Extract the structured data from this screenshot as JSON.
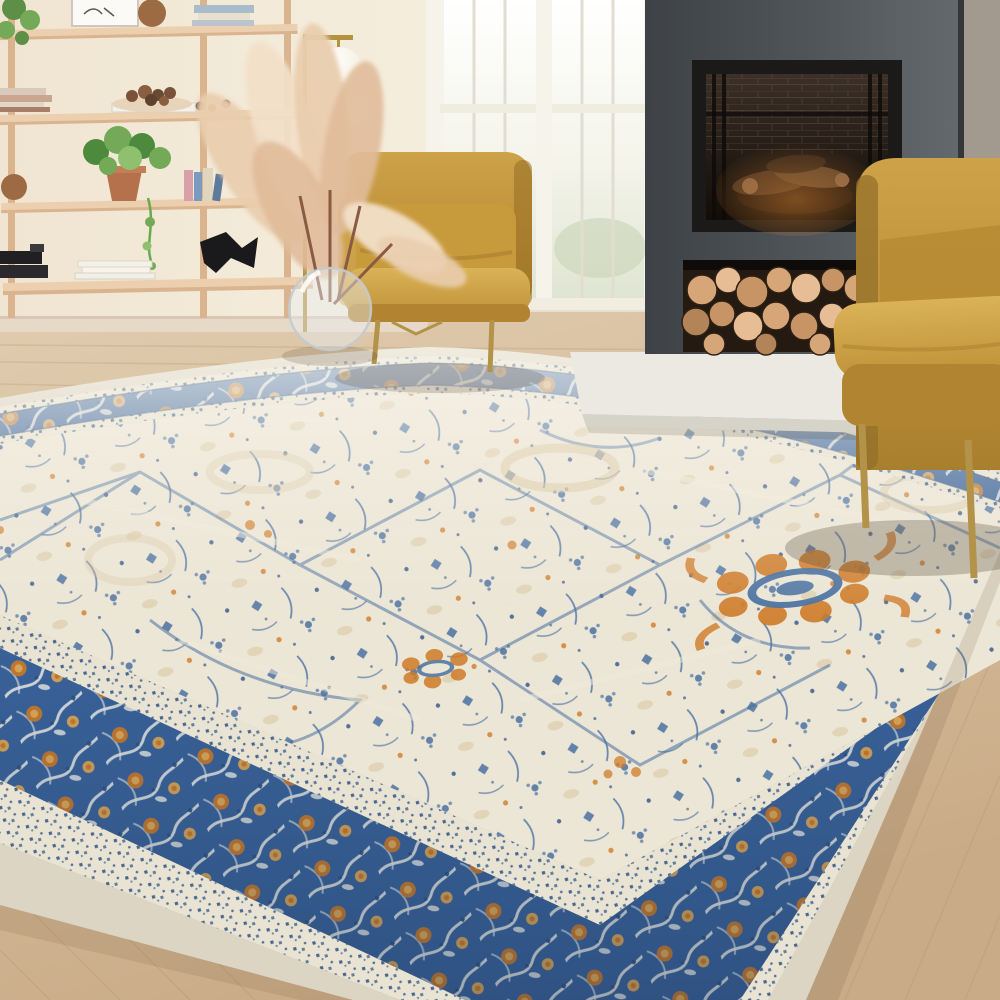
{
  "image_type": "photograph",
  "scene": {
    "setting": "living-room",
    "objects": [
      {
        "name": "wood-shelving-unit",
        "contents": [
          "books",
          "wooden-bowl",
          "decorative-nuts",
          "pothos-plant",
          "terracotta-pot",
          "picture-frame",
          "wooden-sphere",
          "black-sculpture",
          "white-magazines"
        ]
      },
      {
        "name": "brass-floor-lamp",
        "globes": 2
      },
      {
        "name": "window",
        "sashes": 2,
        "view": "bright-garden"
      },
      {
        "name": "fireplace",
        "style": "dark-concrete-surround",
        "features": [
          "black-firebox",
          "brick-interior",
          "stacked-logs-inside",
          "firewood-storage-niche",
          "stone-hearth-slab"
        ]
      },
      {
        "name": "armchair-left",
        "fabric": "mustard-velvet",
        "legs": "gold-metal"
      },
      {
        "name": "armchair-right",
        "fabric": "mustard-velvet",
        "legs": "gold-metal"
      },
      {
        "name": "glass-vase-with-pampas-grass"
      },
      {
        "name": "area-rug",
        "style": "vintage-persian",
        "field": "cream-ivory",
        "border": "navy-blue",
        "accents": [
          "orange",
          "gold",
          "blue"
        ]
      },
      {
        "name": "wood-floor",
        "tone": "light-oak"
      }
    ]
  },
  "palette": {
    "wall-cream": "#f2ead9",
    "wall-bright": "#f9f3e4",
    "baseboard": "#e7d9c8",
    "window-frame": "#f6f3ea",
    "glass-top": "#ffffff",
    "glass-bottom": "#e4e8d4",
    "fireplace-dark-1": "#43474b",
    "fireplace-dark-2": "#5f6568",
    "fireplace-side-wall": "#a29a8f",
    "firebox-black": "#17130f",
    "brick-brown": "#6b5243",
    "glow-orange": "#c27a34",
    "log-tan-1": "#e6bd94",
    "log-tan-2": "#d7a678",
    "log-tan-3": "#c79466",
    "log-tan-5": "#b38457",
    "log-gap-dark": "#241a12",
    "hearth-light": "#ebe9e2",
    "hearth-edge": "#d6d3c9",
    "floor-wood-1": "#dcc5a6",
    "floor-wood-3": "#cdb08d",
    "plank-line": "#b2946f",
    "shelf-wood-1": "#eccfae",
    "shelf-wood-2": "#d9b48f",
    "plant-green-1": "#4e8a3e",
    "plant-green-2": "#73a957",
    "pot-terracotta": "#b5714c",
    "sculpture-black": "#1a1a1c",
    "brass": "#b3933f",
    "globe-white": "#ffffff",
    "chair-mustard-1": "#d4aa4d",
    "chair-mustard-2": "#c1913a",
    "chair-mustard-3": "#a87f2e",
    "leg-gold": "#b3934a",
    "pampas-1": "#f2dfc8",
    "pampas-2": "#e9cdae",
    "stem-brown": "#8a5a43",
    "selvage-cream": "#dcd5c4",
    "guard-cream": "#e8e3d2",
    "rug-border-blue": "#3a639b",
    "rug-border-blue-dark": "#2c4f7f",
    "rug-field-cream": "#ece6d6",
    "rug-motif-blue": "#4a71a1",
    "rug-motif-navy": "#2f5184",
    "rug-orange": "#cf7b28",
    "rug-gold": "#e2ab55",
    "rug-faded-gold": "#d9c49c",
    "pattern-white": "#e9ebe6"
  }
}
